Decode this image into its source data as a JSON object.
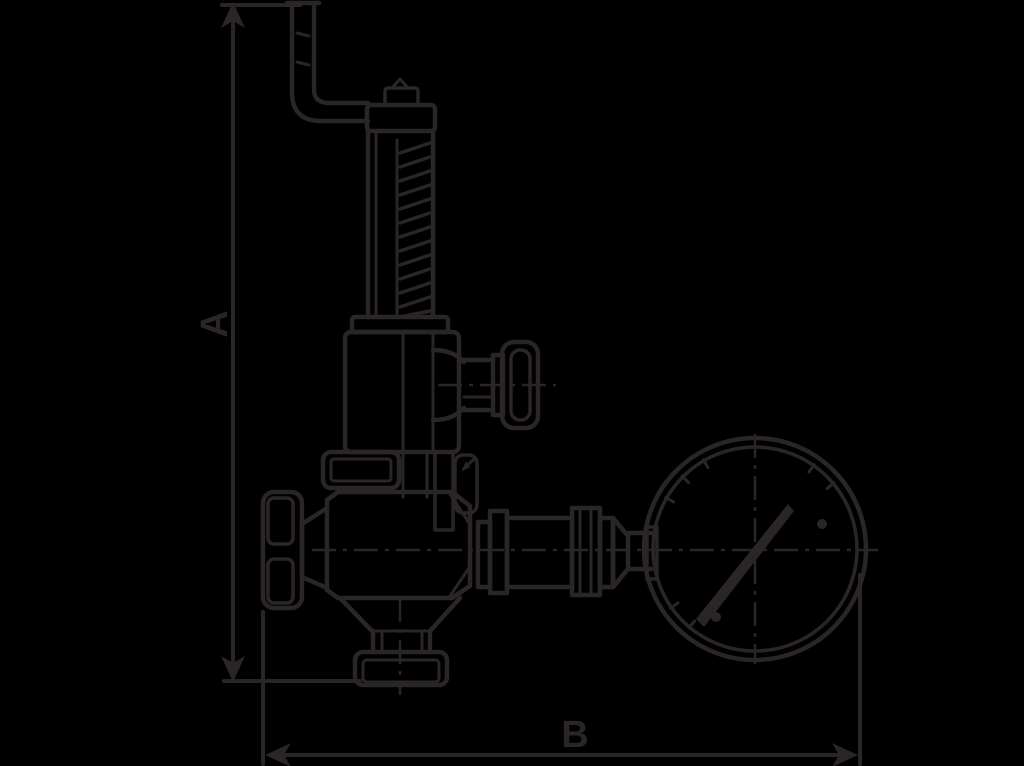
{
  "colors": {
    "background": "#000000",
    "line": "#2a2526"
  },
  "diagram": {
    "type": "technical line drawing",
    "dimension_a": {
      "label": "A"
    },
    "dimension_b": {
      "label": "B"
    },
    "parts": [
      "lifting-lever-pipe",
      "spring-bonnet",
      "spring",
      "bonnet-flange",
      "side-handwheel",
      "valve-body",
      "inlet-handwheel",
      "bottom-outlet-flange",
      "union-coupling-pipe",
      "pressure-gauge"
    ]
  }
}
